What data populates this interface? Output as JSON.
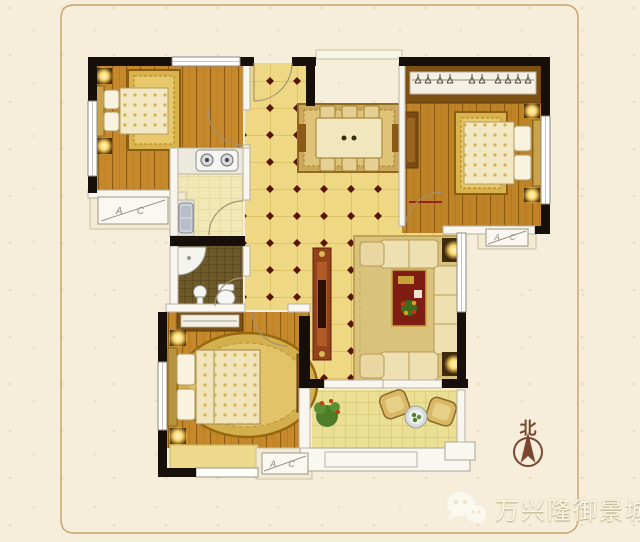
{
  "plan": {
    "type": "apartment-floor-plan",
    "labels": {
      "ac_unit": "A C",
      "compass_north": "北"
    },
    "ac_unit_count": 3
  },
  "watermark": {
    "icon": "wechat-icon",
    "text": "万兴隆御景城"
  },
  "icons": {
    "watermark": "wechat-icon",
    "compass": "north-compass-icon"
  },
  "colors": {
    "background": "#f6eeda",
    "frame_line": "#c8a169",
    "wall": "#17100a",
    "tile_floor": "#eed884",
    "tile_diamond_accent": "#5a1508",
    "wood_floor": "#c5882b",
    "kitchen_floor": "#f2e8b6",
    "bathroom_mosaic": "#6d5a28",
    "balcony_floor": "#ebdf94",
    "lamp_glow": "#ffd76a",
    "coffee_table_red": "#7e1d12",
    "compass_brown": "#7a4631",
    "ac_label_gray": "#8d897d"
  }
}
